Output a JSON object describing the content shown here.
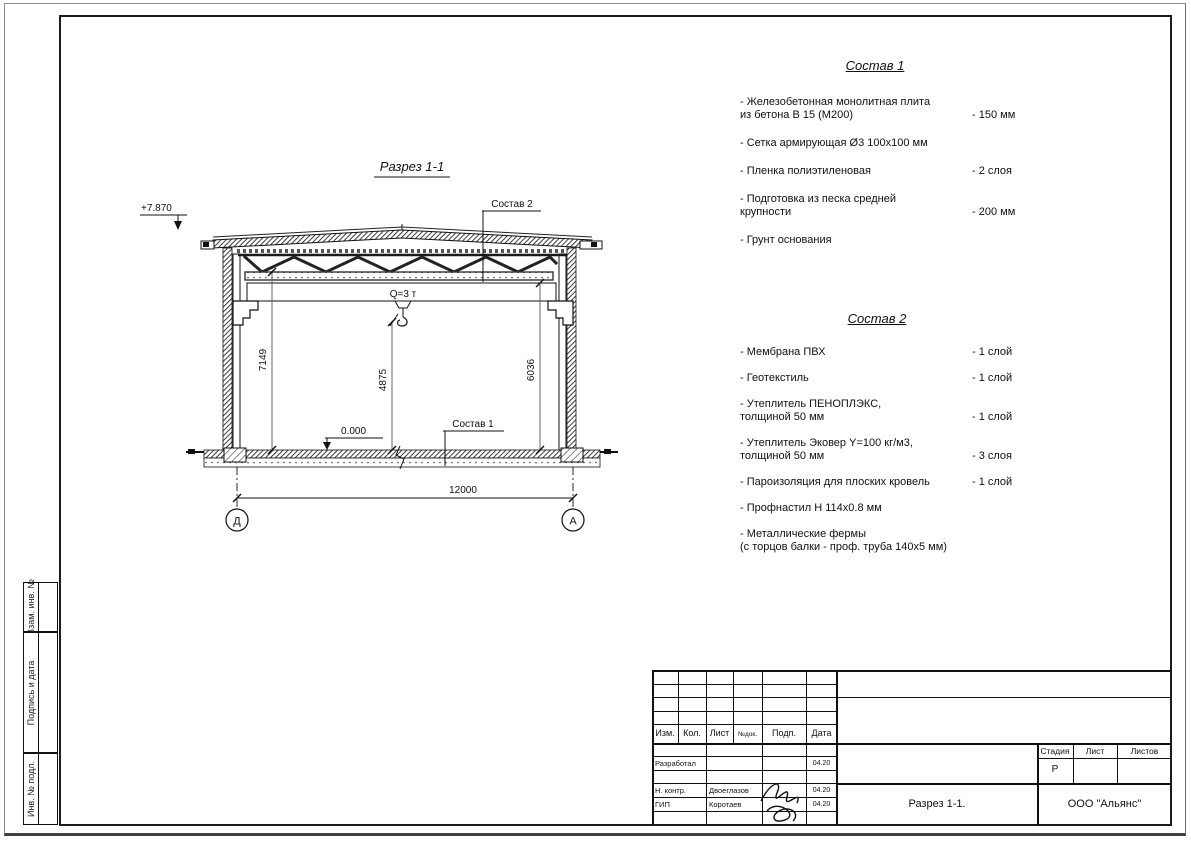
{
  "page": {
    "background": "#ffffff",
    "line_color": "#111111"
  },
  "side_stamps": {
    "vzam": "Взам. инв. №",
    "podpis": "Подпись и дата",
    "inv": "Инв. № подл."
  },
  "drawing": {
    "title": "Разрез 1-1",
    "elevation_top": "+7.870",
    "elevation_zero": "0.000",
    "crane_label": "Q=3 т",
    "callout_roof": "Состав 2",
    "callout_floor": "Состав 1",
    "dims": {
      "left": "7149",
      "mid": "4875",
      "right": "6036",
      "span": "12000"
    },
    "axes": {
      "left": "Д",
      "right": "А"
    }
  },
  "composition1": {
    "title": "Состав 1",
    "items": [
      {
        "name": "- Железобетонная  монолитная плита\nиз бетона В 15 (М200)",
        "value": "- 150 мм"
      },
      {
        "name": "- Сетка армирующая Ø3 100х100 мм",
        "value": ""
      },
      {
        "name": "- Пленка полиэтиленовая",
        "value": "- 2 слоя"
      },
      {
        "name": "- Подготовка из песка средней\nкрупности",
        "value": "- 200 мм"
      },
      {
        "name": "- Грунт основания",
        "value": ""
      }
    ]
  },
  "composition2": {
    "title": "Состав 2",
    "items": [
      {
        "name": "- Мембрана ПВХ",
        "value": "- 1 слой"
      },
      {
        "name": "- Геотекстиль",
        "value": "- 1 слой"
      },
      {
        "name": "- Утеплитель ПЕНОПЛЭКС,\nтолщиной 50 мм",
        "value": "- 1 слой"
      },
      {
        "name": "- Утеплитель Эковер Y=100 кг/м3,\nтолщиной 50 мм",
        "value": "- 3 слоя"
      },
      {
        "name": "- Пароизоляция для плоских кровель",
        "value": "- 1 слой"
      },
      {
        "name": "- Профнастил Н 114х0.8 мм",
        "value": ""
      },
      {
        "name": "- Металлические фермы\n(с торцов балки - проф. труба 140х5 мм)",
        "value": ""
      }
    ]
  },
  "titleblock": {
    "headers": {
      "izm": "Изм.",
      "kol": "Кол.",
      "list": "Лист",
      "ndok": "№док.",
      "podp": "Подп.",
      "data": "Дата"
    },
    "rows": [
      {
        "role": "Разработал",
        "name": "",
        "date": "04.20"
      },
      {
        "role": "Н. контр.",
        "name": "Двоеглазов",
        "date": "04.20"
      },
      {
        "role": "ГИП",
        "name": "Коротаев",
        "date": "04.20"
      }
    ],
    "stage_label": "Стадия",
    "sheet_label": "Лист",
    "sheets_label": "Листов",
    "stage_value": "Р",
    "doc_title": "Разрез 1-1.",
    "company": "ООО \"Альянс\""
  }
}
